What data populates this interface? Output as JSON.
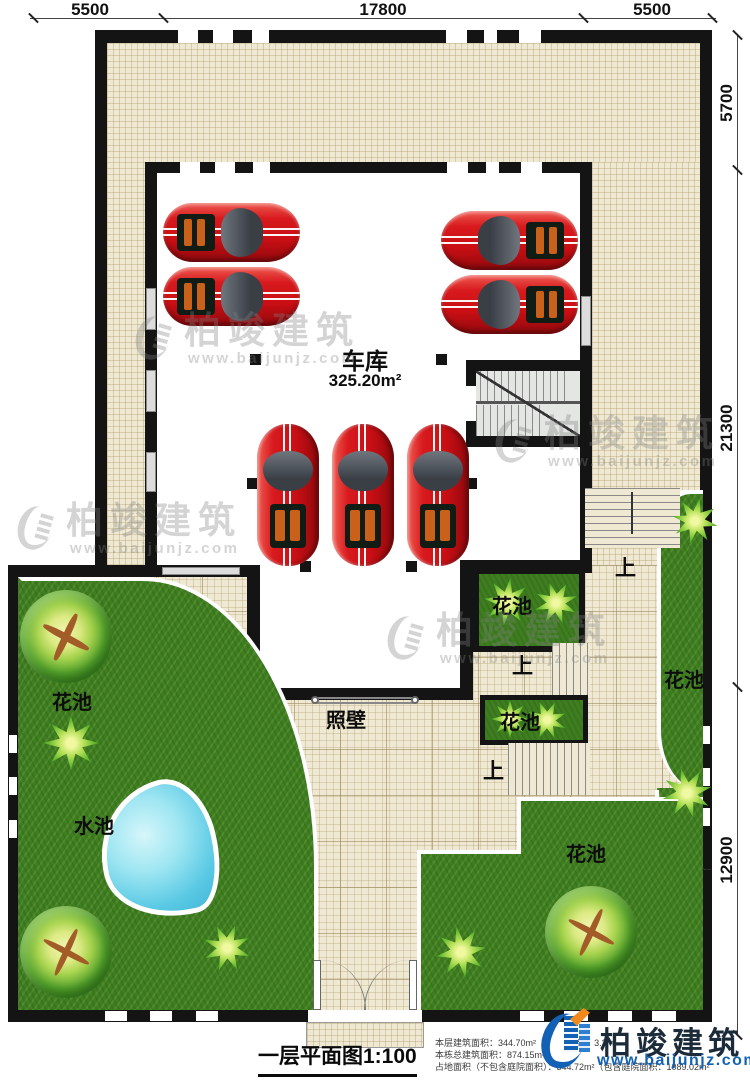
{
  "dimensions": {
    "top": [
      "5500",
      "17800",
      "5500"
    ],
    "right": [
      "5700",
      "21300",
      "12900"
    ]
  },
  "garage": {
    "label": "车库",
    "area": "325.20m²"
  },
  "labels": {
    "flower_bed": "花池",
    "water_pool": "水池",
    "screen_wall": "照壁",
    "stairs_up": "上"
  },
  "title_block": {
    "drawing_title": "一层平面图1:100",
    "info_line_1": "本层建筑面积：344.70m²",
    "info_line_1b": "层高：3.3m",
    "info_line_2": "本栋总建筑面积：874.15m²",
    "info_line_3": "占地面积（不包含庭院面积）：344.72m²（包含庭院面积：1089.02m²"
  },
  "branding": {
    "company": "柏竣建筑",
    "website": "www.baijunjz.com"
  },
  "watermark": {
    "company": "柏竣建筑",
    "website": "www.baijunjz.com"
  },
  "colors": {
    "wall": "#141414",
    "floor_tile": "#efe8d3",
    "grass": "#3f7e20",
    "pool_water": "#59c9e4",
    "car": "#d01318",
    "logo_blue": "#1261b4",
    "logo_orange": "#f08a1d"
  }
}
